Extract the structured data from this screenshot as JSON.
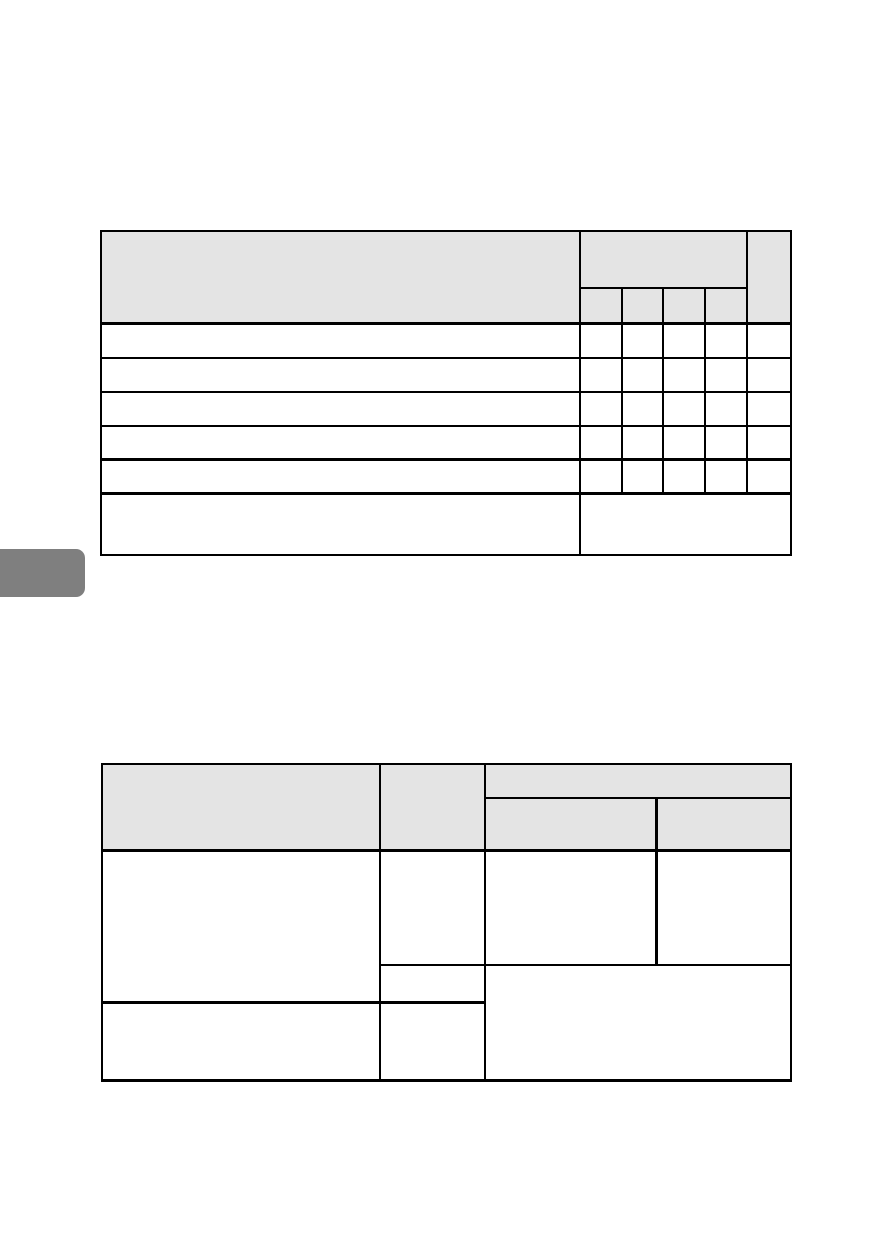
{
  "page": {
    "background_color": "#ffffff",
    "visible_text": "",
    "content_note": "blank manual page: two empty table templates, no text rendered"
  },
  "colors": {
    "page_background": "#ffffff",
    "table_border": "#000000",
    "table_header_fill": "#e4e4e4",
    "side_tab_fill": "#7f7f7f"
  },
  "side_tab": {
    "shape": "rounded-right gray tab on left page edge"
  },
  "table_top": {
    "column_count": 6,
    "sub_column_count": 4,
    "header_row_count": 2,
    "body_row_count": 5,
    "has_merged_footer_row": true,
    "all_cells_empty": true
  },
  "table_bottom": {
    "column_count": 4,
    "header_group_span": 2,
    "header_row_count": 2,
    "body_row_count": 2,
    "has_merged_bottom_right_region": true,
    "all_cells_empty": true
  }
}
